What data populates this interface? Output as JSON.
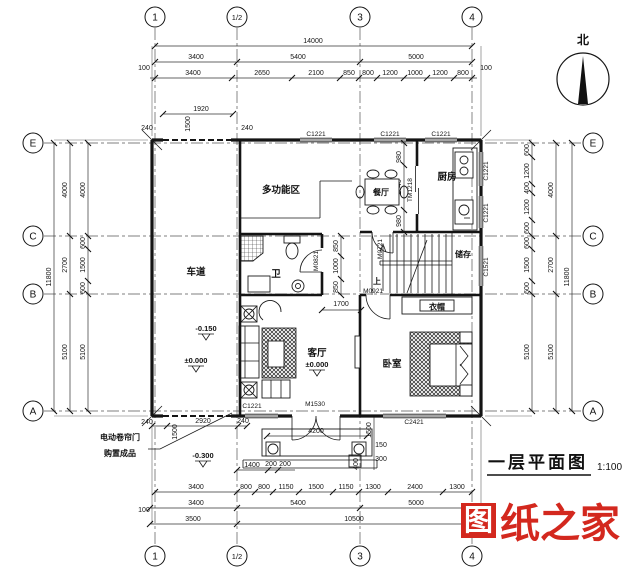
{
  "title": {
    "text": "一层平面图",
    "scale": "1:100"
  },
  "watermark": {
    "stamp": "图",
    "rest": "纸之家"
  },
  "north": {
    "label": "北"
  },
  "grid": {
    "cols": [
      "1",
      "1/2",
      "3",
      "4"
    ],
    "rows": [
      "E",
      "C",
      "B",
      "A"
    ]
  },
  "rooms": {
    "garage": "车道",
    "multifunction": "多功能区",
    "dining": "餐厅",
    "kitchen": "厨房",
    "bath": "卫",
    "storage": "储存",
    "stair_up": "上",
    "wardrobe": "衣帽",
    "bedroom": "卧室",
    "living": "客厅"
  },
  "levels": {
    "garage_mid": "-0.150",
    "garage_zero": "±0.000",
    "living_zero": "±0.000",
    "porch": "-0.300"
  },
  "notes": {
    "line1": "电动卷帘门",
    "line2": "购置成品"
  },
  "windows": {
    "top": [
      "C1221",
      "C1221",
      "C1221"
    ],
    "right": [
      "C1221",
      "C1221",
      "C1521"
    ],
    "bottom_living": "C1221",
    "bottom_bedroom": "C2421"
  },
  "doors": {
    "entrance": "M1530",
    "bedroom": "M0921",
    "stair": "M0721",
    "bath": "M0821",
    "kitchen": "TM1218"
  },
  "dims": {
    "top1": "14000",
    "top2": [
      "3400",
      "5400",
      "5000"
    ],
    "end100": "100",
    "top3": [
      "3400",
      "2650",
      "2100",
      "850",
      "800",
      "1200",
      "1000",
      "1200",
      "800"
    ],
    "bottom1": [
      "3400",
      "800",
      "800",
      "1150",
      "1500",
      "1150",
      "1300",
      "2400",
      "1300"
    ],
    "bottom2": [
      "100",
      "3400",
      "5400",
      "5000",
      "100"
    ],
    "bottom3": [
      "3500",
      "10500"
    ],
    "left_outer": "11800",
    "left_mid": [
      "4000",
      "2700",
      "5100"
    ],
    "left_inner": [
      "4000",
      "600",
      "1500",
      "600",
      "5100"
    ],
    "right_inner": [
      "600",
      "1200",
      "400",
      "1200",
      "600",
      "600",
      "1500",
      "600",
      "5100"
    ],
    "right_mid": [
      "4000",
      "2700",
      "5100"
    ],
    "right_outer": "11800",
    "garage_top": [
      "240",
      "1500",
      "1920",
      "240"
    ],
    "garage_bottom": [
      "240",
      "1500",
      "2920",
      "240"
    ],
    "bath_col": [
      "850",
      "1000",
      "850"
    ],
    "dining_col": [
      "980",
      "2040",
      "980"
    ],
    "hall": "1700",
    "porch": [
      "4200",
      "1500",
      "150",
      "300",
      "400",
      "1400",
      "200",
      "200"
    ]
  }
}
